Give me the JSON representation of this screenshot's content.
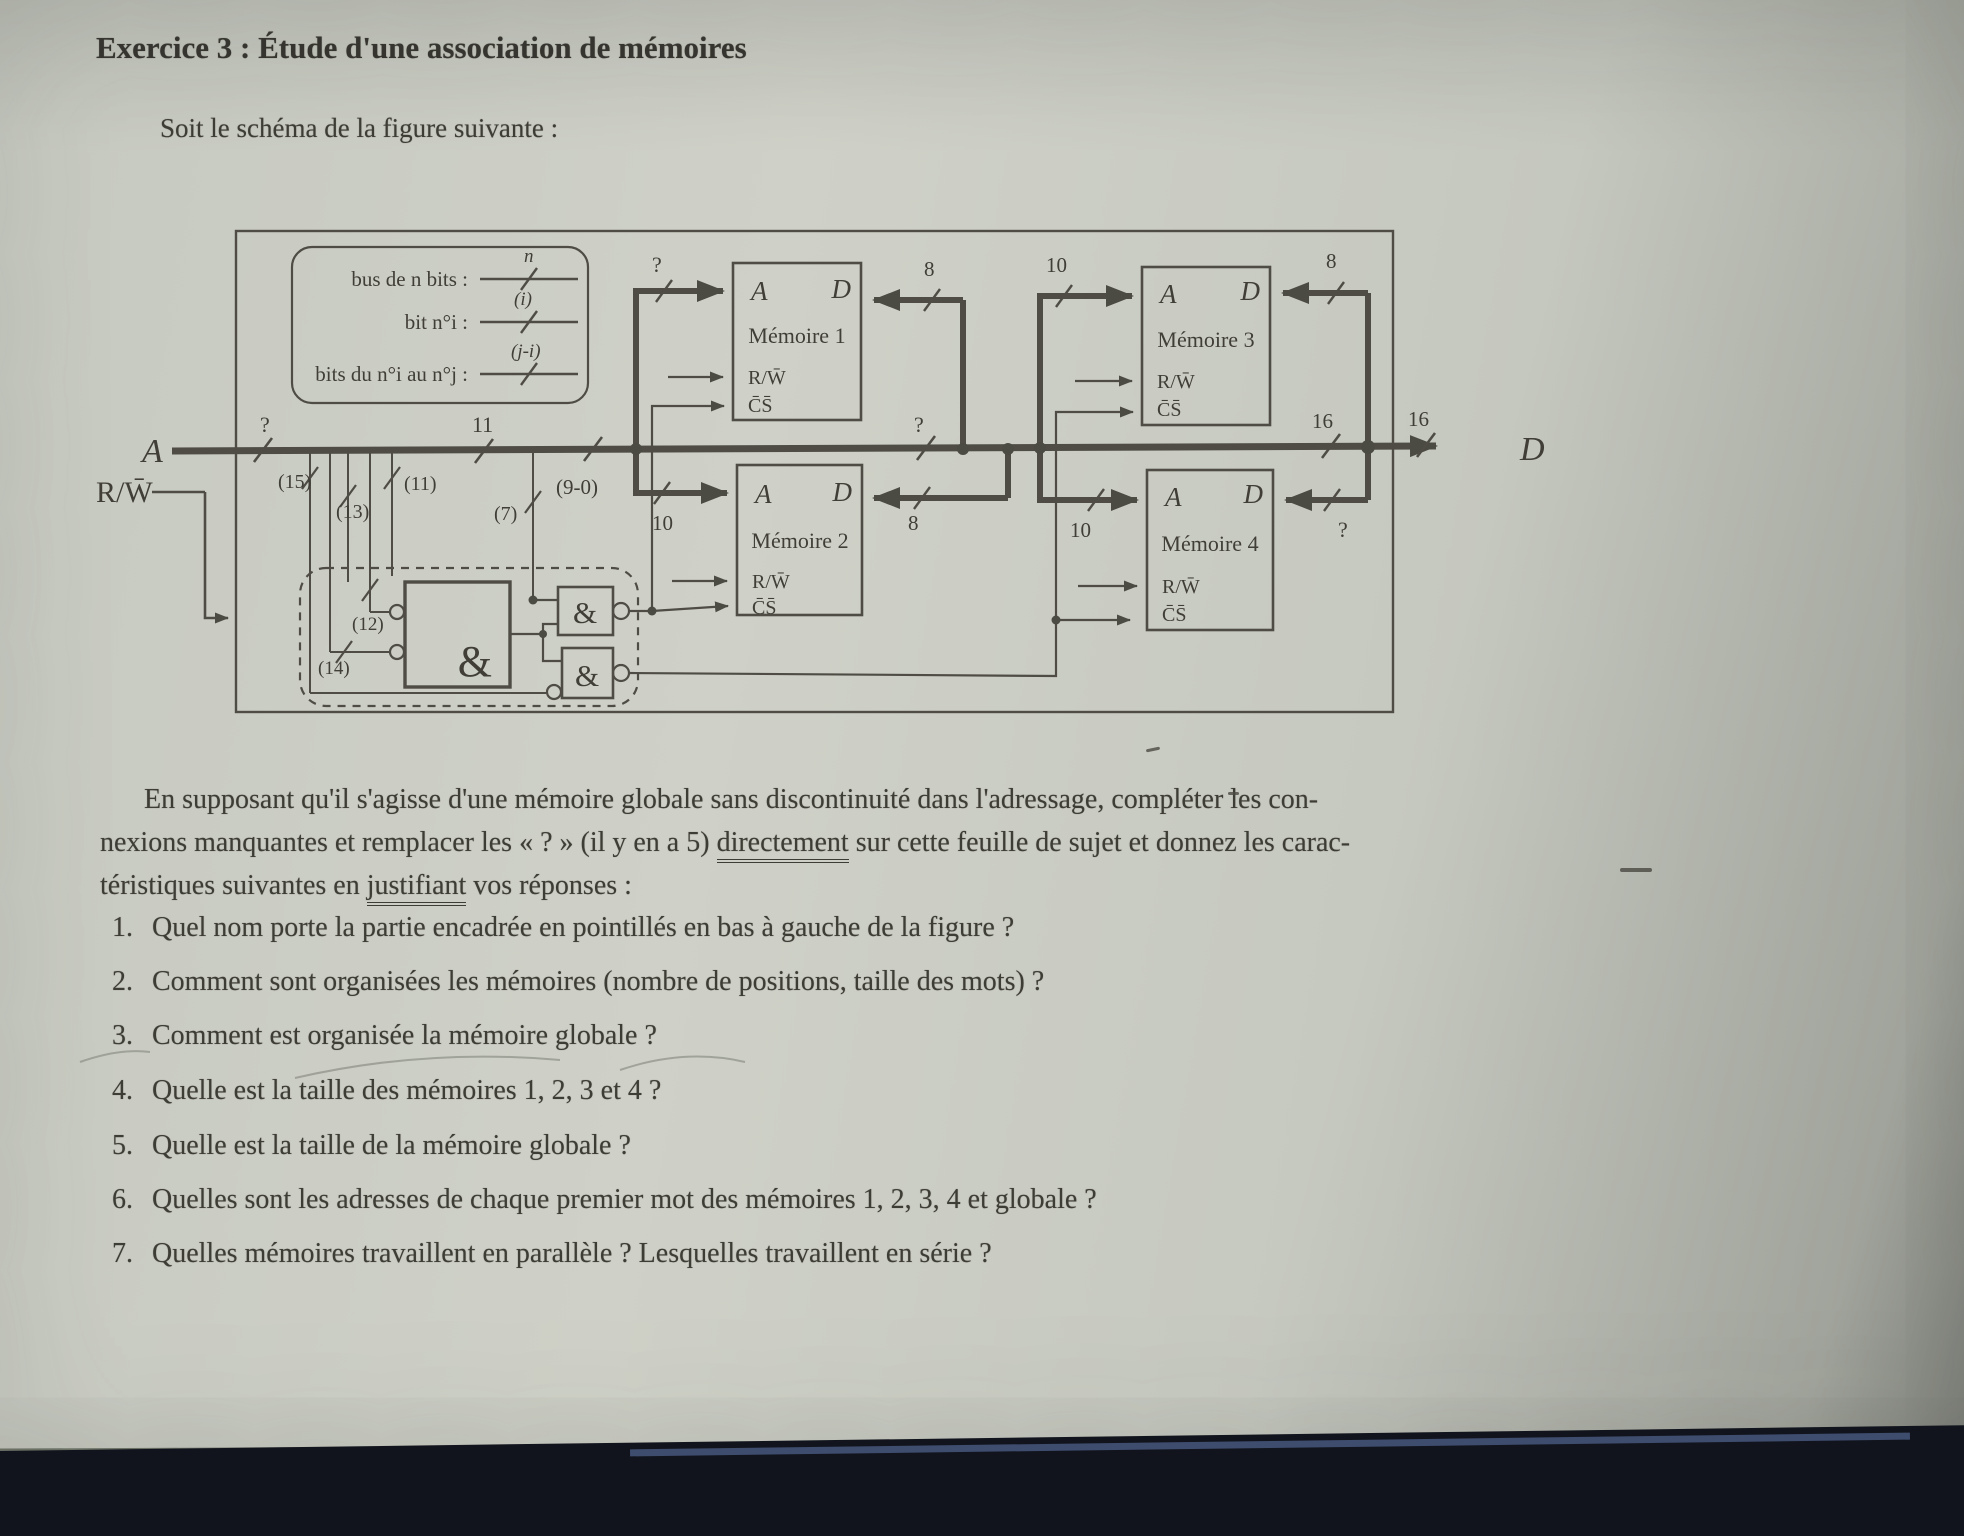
{
  "page": {
    "title": "Exercice 3 : Étude d'une association de mémoires",
    "subtitle": "Soit le schéma de la figure suivante :"
  },
  "figure": {
    "legend": {
      "r1": "bus de n bits :",
      "r1t": "n",
      "r2": "bit n°i :",
      "r2t": "(i)",
      "r3": "bits du n°i au n°j :",
      "r3t": "(j-i)"
    },
    "ext": {
      "a": "A",
      "d": "D",
      "rw": "R/W̄"
    },
    "bus": {
      "aw": "?",
      "a11": "11",
      "seg90": "(9-0)",
      "midq": "?",
      "d16a": "16",
      "d16b": "16"
    },
    "taps": {
      "t15": "(15)",
      "t13": "(13)",
      "t11": "(11)",
      "t12": "(12)",
      "t14": "(14)",
      "t7": "(7)"
    },
    "mem1": {
      "name": "Mémoire 1",
      "a": "A",
      "d": "D",
      "rw": "R/W̄",
      "cs": "C̄S̄",
      "ab": "?",
      "db": "8"
    },
    "mem2": {
      "name": "Mémoire 2",
      "a": "A",
      "d": "D",
      "rw": "R/W̄",
      "cs": "C̄S̄",
      "ab": "10",
      "db": "8"
    },
    "mem3": {
      "name": "Mémoire 3",
      "a": "A",
      "d": "D",
      "rw": "R/W̄",
      "cs": "C̄S̄",
      "ab": "10",
      "db": "8"
    },
    "mem4": {
      "name": "Mémoire 4",
      "a": "A",
      "d": "D",
      "rw": "R/W̄",
      "cs": "C̄S̄",
      "ab": "10",
      "db": "?"
    },
    "gates": {
      "g1": "&",
      "g2": "&",
      "g3": "&"
    }
  },
  "body": {
    "p1": "En supposant qu'il s'agisse d'une mémoire globale sans discontinuité dans l'adressage, compléter les con-",
    "p2a": "nexions manquantes et remplacer les « ? » (il y en a 5) ",
    "p2u": "directement",
    "p2b": " sur cette feuille de sujet et donnez les carac-",
    "p3a": "téristiques suivantes en ",
    "p3u": "justifiant",
    "p3b": " vos réponses :",
    "questions": [
      {
        "num": "1.",
        "text": "Quel nom porte la partie encadrée en pointillés en bas à gauche de la figure ?"
      },
      {
        "num": "2.",
        "text": "Comment sont organisées les mémoires (nombre de positions, taille des mots) ?"
      },
      {
        "num": "3.",
        "text": "Comment est organisée la mémoire globale ?"
      },
      {
        "num": "4.",
        "text": "Quelle est la taille des mémoires 1, 2, 3 et 4 ?"
      },
      {
        "num": "5.",
        "text": "Quelle est la taille de la mémoire globale ?"
      },
      {
        "num": "6.",
        "text": "Quelles sont les adresses de chaque premier mot des mémoires 1, 2, 3, 4 et globale ?"
      },
      {
        "num": "7.",
        "text": "Quelles mémoires travaillent en parallèle ? Lesquelles travaillent en série ?"
      }
    ]
  }
}
